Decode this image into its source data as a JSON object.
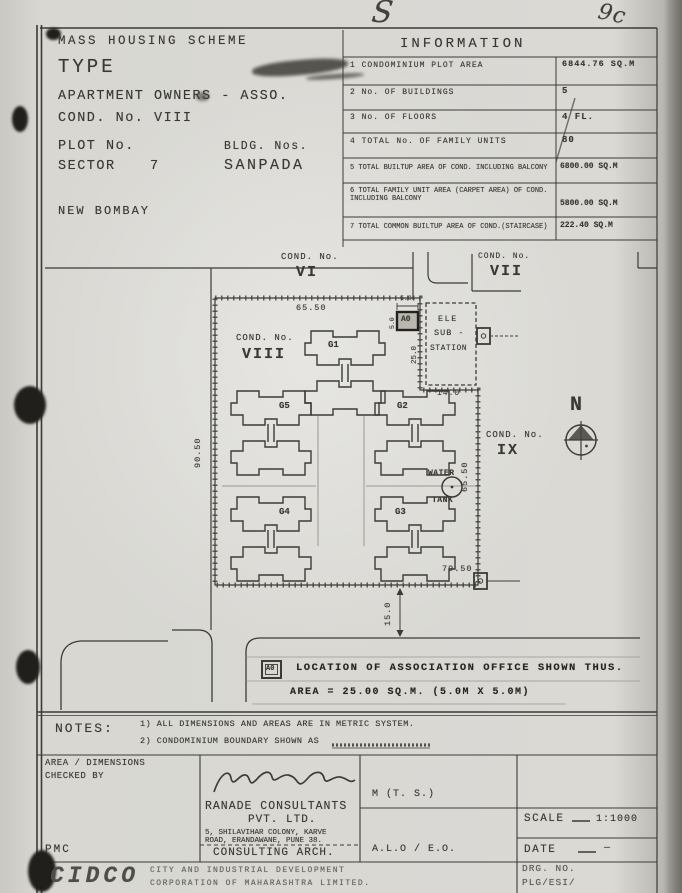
{
  "annotations": {
    "top_center": "S",
    "top_right": "9c"
  },
  "header": {
    "scheme_title": "MASS HOUSING SCHEME",
    "type_label": "TYPE",
    "owner_line": "APARTMENT OWNERS - ASSO.",
    "cond_no": "COND. No. VIII",
    "plot_no_label": "PLOT No.",
    "bldg_nos_label": "BLDG. Nos.",
    "sector_label": "SECTOR",
    "sector_value": "7",
    "node_name": "SANPADA",
    "city": "NEW BOMBAY"
  },
  "information": {
    "title": "INFORMATION",
    "rows": [
      {
        "label": "1 CONDOMINIUM  PLOT AREA",
        "value": "6844.76 SQ.M"
      },
      {
        "label": "2 No. OF BUILDINGS",
        "value": "5"
      },
      {
        "label": "3 No. OF FLOORS",
        "value": "4 FL."
      },
      {
        "label": "4 TOTAL No. OF FAMILY UNITS",
        "value": "80"
      },
      {
        "label": "5 TOTAL BUILTUP AREA OF COND. INCLUDING BALCONY",
        "value": "6800.00 SQ.M"
      },
      {
        "label": "6 TOTAL FAMILY UNIT AREA (CARPET AREA) OF COND. INCLUDING BALCONY",
        "value": "5800.00 SQ.M"
      },
      {
        "label": "7 TOTAL COMMON BUILTUP AREA OF COND.(STAIRCASE)",
        "value": "222.40 SQ.M"
      }
    ]
  },
  "plan": {
    "cond_vi_label": "COND. No.",
    "cond_vi": "VI",
    "cond_vii_label": "COND. No.",
    "cond_vii": "VII",
    "cond_viii_label": "COND. No.",
    "cond_viii": "VIII",
    "cond_ix_label": "COND. No.",
    "cond_ix": "IX",
    "buildings": {
      "g1": "G1",
      "g2": "G2",
      "g3": "G3",
      "g4": "G4",
      "g5": "G5"
    },
    "ele_l1": "ELE",
    "ele_l2": "SUB -",
    "ele_l3": "STATION",
    "water_l1": "WATER",
    "water_l2": "TANK",
    "office_marker": "A0",
    "north": "N",
    "dims": {
      "top": "65.50",
      "left": "90.50",
      "right": "65.50",
      "bottom": "79.50",
      "road": "15.0",
      "ele_width": "14.0",
      "ele_gap": "25.0",
      "office_w": "5.0",
      "office_h": "5.0"
    }
  },
  "legend": {
    "marker": "A0",
    "text": "LOCATION OF ASSOCIATION OFFICE SHOWN THUS.",
    "area_line": "AREA = 25.00 SQ.M.  (5.0M X 5.0M)"
  },
  "notes": {
    "label": "NOTES:",
    "n1": "1) ALL DIMENSIONS AND AREAS ARE IN METRIC SYSTEM.",
    "n2": "2) CONDOMINIUM BOUNDARY SHOWN AS"
  },
  "titleblock": {
    "checked_l1": "AREA / DIMENSIONS",
    "checked_l2": "CHECKED BY",
    "pmc": "PMC",
    "consultant_l1": "RANADE CONSULTANTS",
    "consultant_l2": "PVT. LTD.",
    "address_l1": "5, SHILAVIHAR COLONY, KARVE",
    "address_l2": "ROAD, ERANDAWANE, PUNE 38.",
    "consulting": "CONSULTING ARCH.",
    "mts": "M (T. S.)",
    "aloeo": "A.L.O / E.O.",
    "scale_label": "SCALE",
    "scale_value": "1:1000",
    "date_label": "DATE",
    "dash": "—",
    "drg_label": "DRG. NO.",
    "drg_value": "PLG/ESI/",
    "cidco": "CIDCO",
    "corp_l1": "CITY  AND  INDUSTRIAL  DEVELOPMENT",
    "corp_l2": "CORPORATION  OF  MAHARASHTRA  LIMITED."
  }
}
